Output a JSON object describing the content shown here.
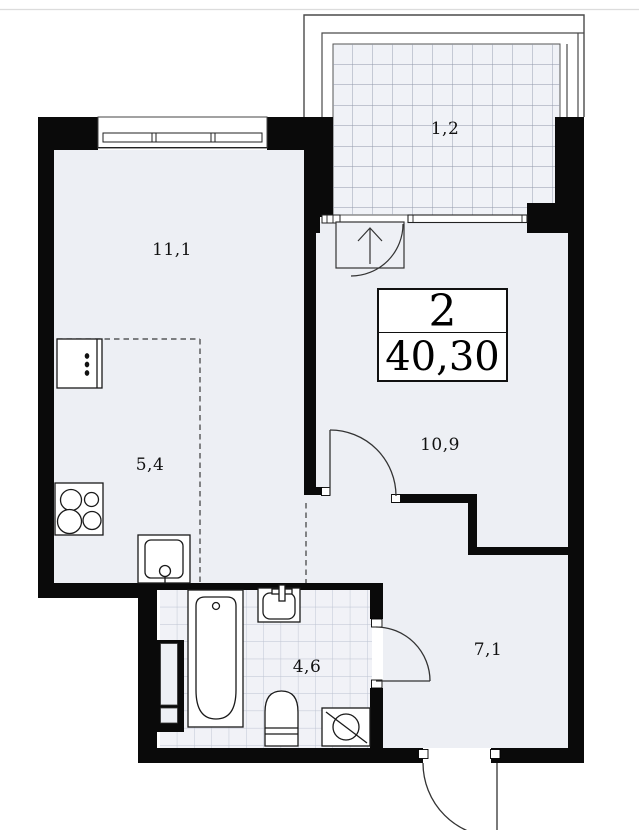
{
  "plan_type": "apartment-floor-plan",
  "info_box": {
    "room_count": "2",
    "total_area": "40,30"
  },
  "rooms": {
    "living": {
      "area": "11,1"
    },
    "balcony": {
      "area": "1,2"
    },
    "kitchen": {
      "area": "5,4"
    },
    "bedroom": {
      "area": "10,9"
    },
    "bathroom": {
      "area": "4,6"
    },
    "hallway": {
      "area": "7,1"
    }
  },
  "colors": {
    "wall": "#0a0a0a",
    "floor": "#edeff4",
    "balcony_tile_bg": "#f0f2f7",
    "balcony_grid_line": "#9097a9",
    "bathroom_grid_line": "#bcc2d0",
    "outline": "#1a1a1a"
  }
}
